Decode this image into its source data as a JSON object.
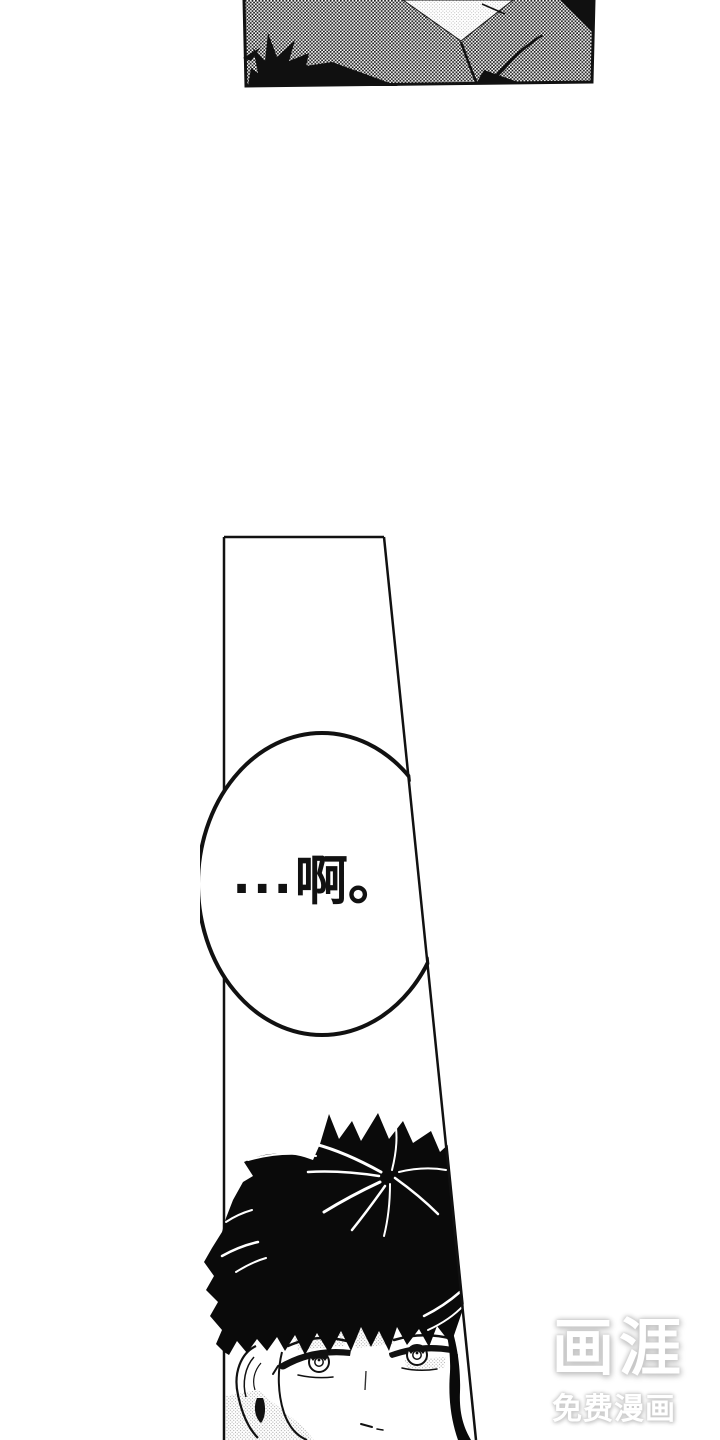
{
  "page": {
    "width": 720,
    "height": 1440,
    "background_color": "#ffffff",
    "ink_color": "#111111",
    "halftone_dot_color": "#1e1e1e"
  },
  "speech_bubble": {
    "ellipsis": "...",
    "word": "啊。",
    "full_text": "...啊。"
  },
  "watermark": {
    "logo": "画涯",
    "tagline": "免费漫画",
    "text_color": "#ffffff"
  }
}
